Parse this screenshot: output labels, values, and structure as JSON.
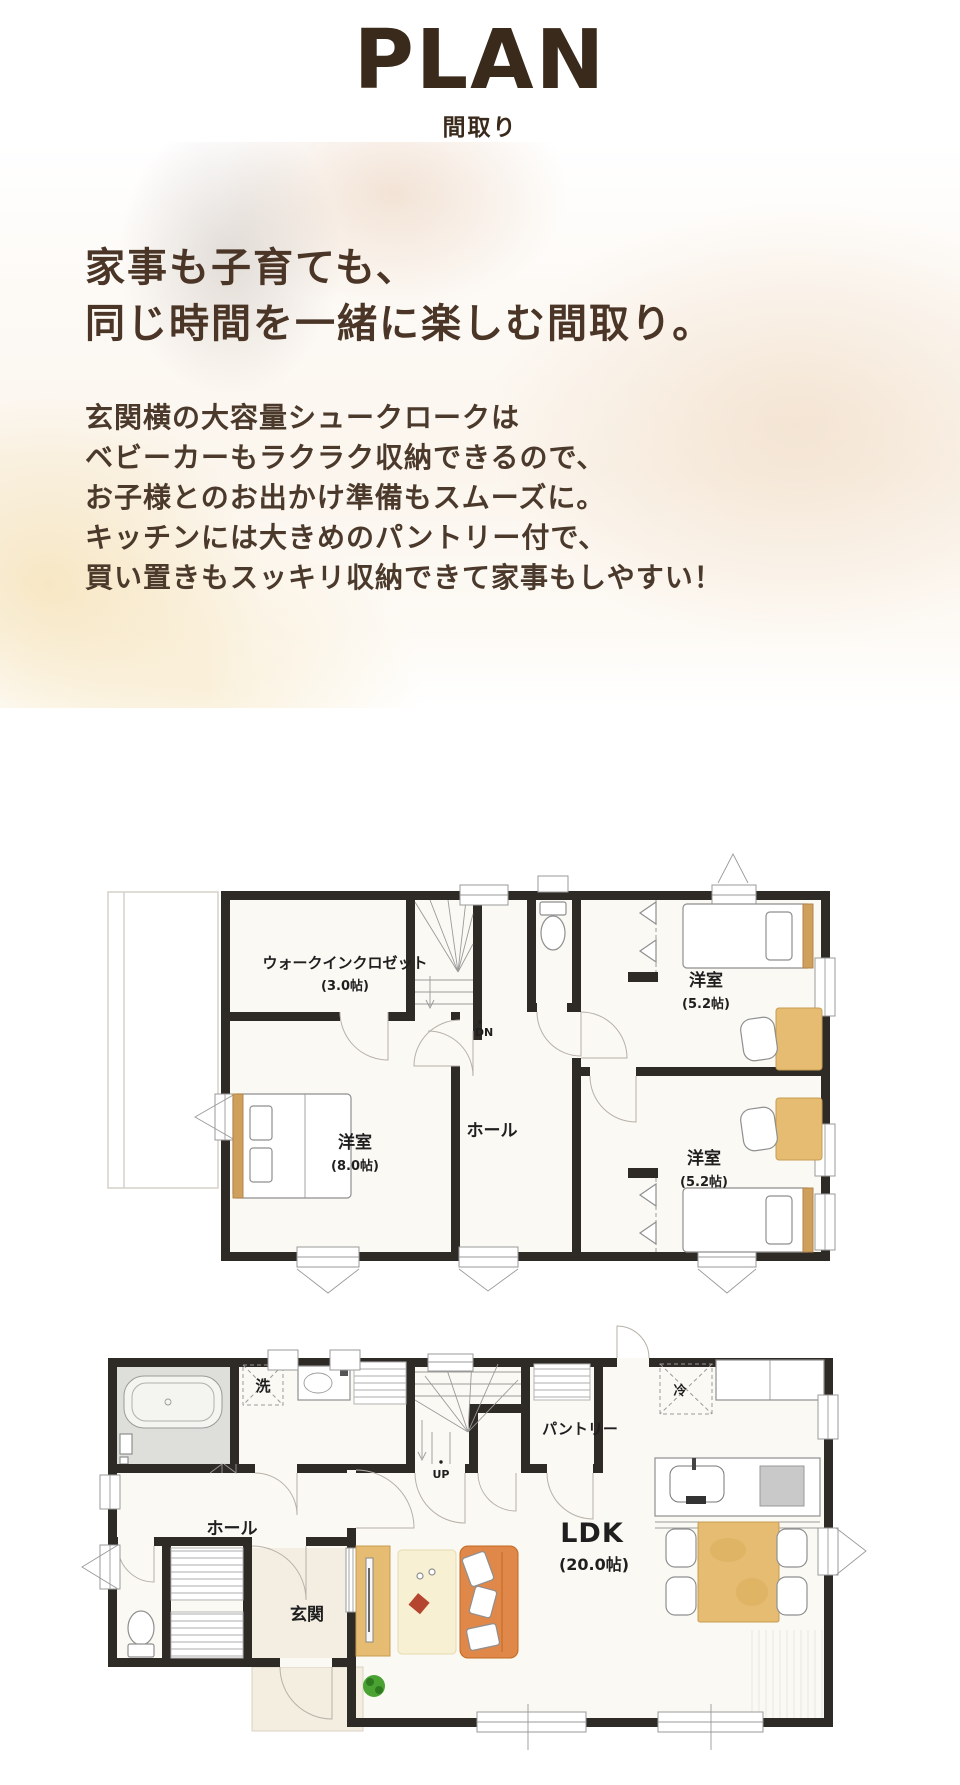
{
  "page": {
    "title": "PLAN",
    "subtitle": "間取り"
  },
  "intro": {
    "heading_lines": [
      "家事も子育ても、",
      "同じ時間を一緒に楽しむ間取り。"
    ],
    "body_lines": [
      "玄関横の大容量シュークロークは",
      "ベビーカーもラクラク収納できるので、",
      "お子様とのお出かけ準備もスムーズに。",
      "キッチンには大きめのパントリー付で、",
      "買い置きもスッキリ収納できて家事もしやすい！"
    ]
  },
  "colors": {
    "title_brown": "#3a2a1b",
    "heading_brown": "#4a3527",
    "body_brown": "#4b3a2b",
    "wall": "#2e2a26",
    "wood_accent": "#e5bc72",
    "sofa_orange": "#e0874a",
    "plant_green": "#4aa233"
  },
  "plan_2f": {
    "walk_in_closet": {
      "name": "ウォークインクロゼット",
      "size": "(3.0帖)"
    },
    "bedroom_main": {
      "name": "洋室",
      "size": "(8.0帖)"
    },
    "bedroom_upper": {
      "name": "洋室",
      "size": "(5.2帖)"
    },
    "bedroom_lower": {
      "name": "洋室",
      "size": "(5.2帖)"
    },
    "hall": {
      "name": "ホール"
    },
    "stairs_label": "DN"
  },
  "plan_1f": {
    "ldk": {
      "name": "LDK",
      "size": "(20.0帖)"
    },
    "hall": {
      "name": "ホール"
    },
    "entrance": {
      "name": "玄関"
    },
    "pantry": {
      "name": "パントリー"
    },
    "laundry_label": "洗",
    "fridge_label": "冷",
    "stairs_label": "UP"
  }
}
